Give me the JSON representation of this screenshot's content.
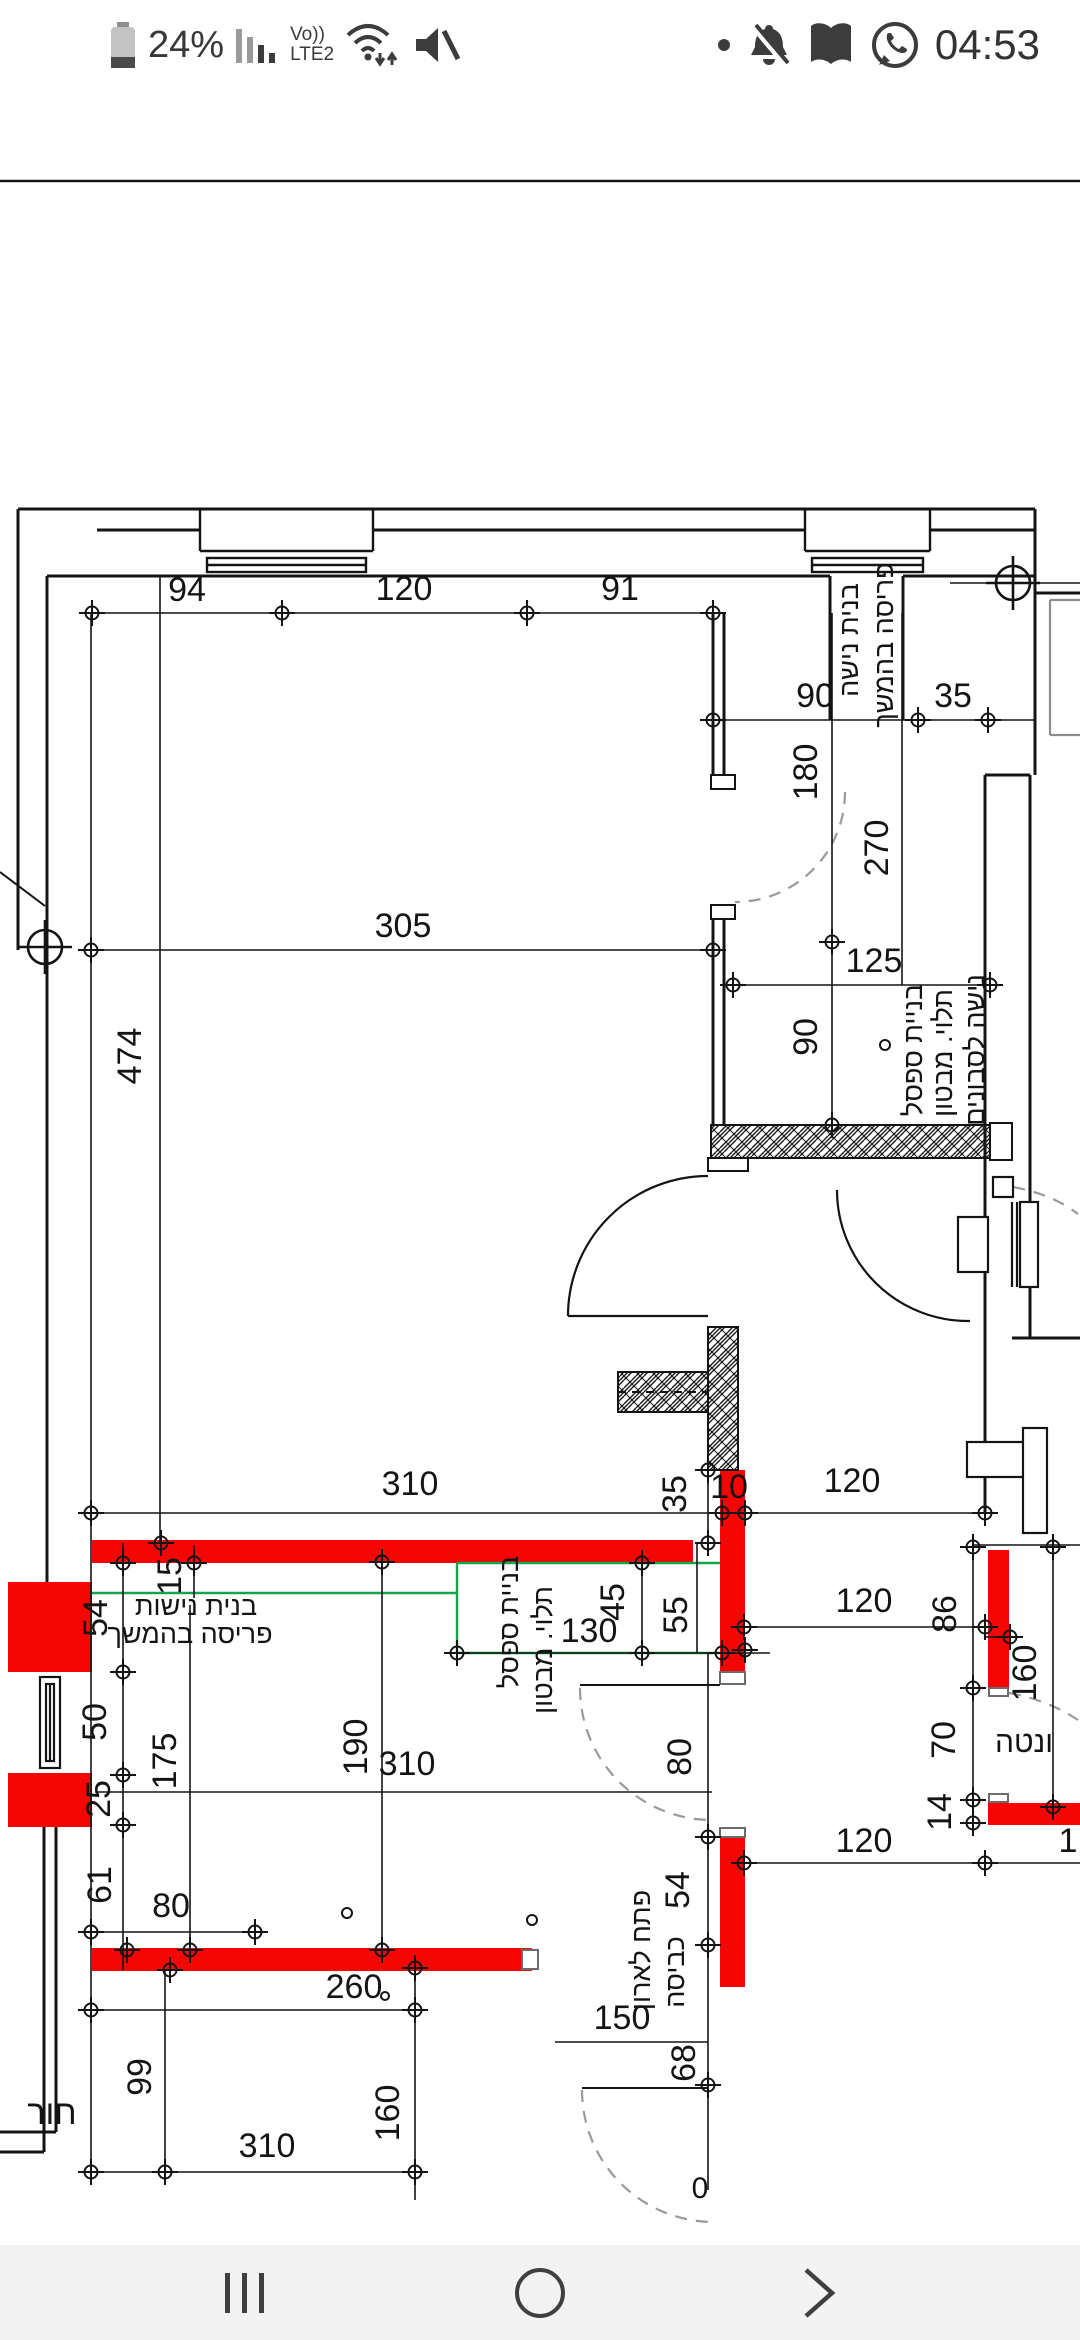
{
  "status": {
    "battery_percent": "24%",
    "volte_label": "Vo))",
    "network_label": "LTE2",
    "time": "04:53"
  },
  "plan": {
    "dims": {
      "d94": "94",
      "d120a": "120",
      "d91": "91",
      "d90a": "90",
      "d35a": "35",
      "d180": "180",
      "d270": "270",
      "d305": "305",
      "d474": "474",
      "d125": "125",
      "d90b": "90",
      "d310a": "310",
      "d35b": "35",
      "d10": "10",
      "d120b": "120",
      "d15": "15",
      "d54a": "54",
      "d50": "50",
      "d25": "25",
      "d61": "61",
      "d175": "175",
      "d190": "190",
      "d80a": "80",
      "d45": "45",
      "d55": "55",
      "d130": "130",
      "d310b": "310",
      "d80b": "80",
      "d54b": "54",
      "d150": "150",
      "d68": "68",
      "d120c": "120",
      "d86": "86",
      "d160a": "160",
      "d70": "70",
      "d14": "14",
      "d120d": "120",
      "d1": "1",
      "d260": "260",
      "d99": "99",
      "d160b": "160",
      "d310c": "310",
      "d0": "0"
    },
    "labels": {
      "niche_a1": "בנית נישה",
      "niche_a2": "פריסה בהמשך",
      "bench_a1": "בניית ספסל",
      "bench_a2": "תלוי. מבטון",
      "bench_a3": "נישה לסבונים",
      "niche_b1": "בנית נישות",
      "niche_b2": "פריסה בהמשך",
      "bench_b1": "בניית ספסל",
      "bench_b2": "תלוי. מבטון",
      "laundry1": "פתח לארון",
      "laundry2": "כביסה",
      "vent": "ונטה",
      "room_partial": "חור"
    },
    "colors": {
      "wall_highlight": "#f60505",
      "planned_outline": "#16a34a",
      "line": "#141414",
      "dash": "#9a9a9a"
    }
  }
}
